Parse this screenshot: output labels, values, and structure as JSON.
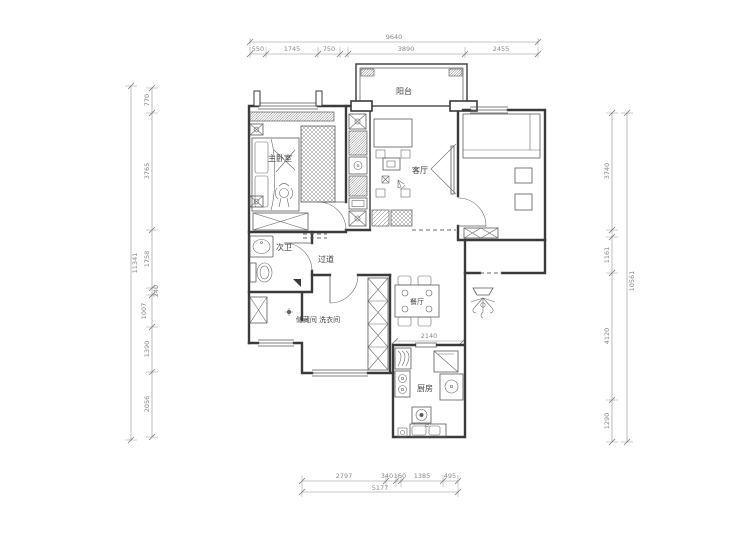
{
  "rooms": {
    "balcony": "阳台",
    "master_bedroom": "主卧室",
    "living_room": "客厅",
    "bathroom": "次卫",
    "hallway": "过道",
    "storage": "储藏间 洗衣间",
    "dining": "餐厅",
    "kitchen": "厨房"
  },
  "dims": {
    "top_total": "9640",
    "top": [
      "550",
      "1745",
      "750",
      "3890",
      "2455"
    ],
    "left_total": "11341",
    "left": [
      "770",
      "3765",
      "1758",
      "240",
      "1007",
      "1390",
      "2056"
    ],
    "right_total": "10561",
    "right": [
      "3740",
      "1161",
      "4120",
      "1290"
    ],
    "bottom_total": "5177",
    "bottom": [
      "2797",
      "340",
      "160",
      "1385",
      "495"
    ],
    "kitchen_width": "2140"
  },
  "colors": {
    "wall": "#3a3a3a",
    "furniture": "#5a5a5a",
    "dimension": "#8a8a8a",
    "background": "#ffffff"
  }
}
